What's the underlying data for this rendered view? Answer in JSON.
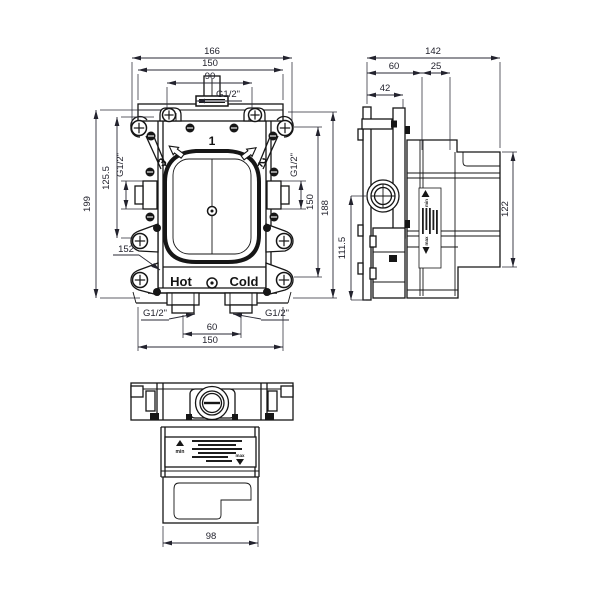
{
  "front": {
    "dim_overall_width": "166",
    "dim_flange_width_top": "150",
    "dim_top_port_span": "90",
    "thread_top": "G1/2\"",
    "dim_total_height": "199",
    "dim_side_port_height": "125.5",
    "thread_left": "G1/2\"",
    "dim_ref": "152",
    "thread_right": "G1/2\"",
    "dim_ear_span_right": "150",
    "dim_right_height": "188",
    "port_top": "1",
    "port_right": "2",
    "port_left": "3",
    "label_hot": "Hot",
    "label_cold": "Cold",
    "thread_bottom_left": "G1/2\"",
    "thread_bottom_right": "G1/2\"",
    "dim_bottom_port_span": "60",
    "dim_flange_width_bottom": "150"
  },
  "side": {
    "dim_total_depth": "142",
    "dim_front_depth": "60",
    "dim_mid_depth": "25",
    "dim_plate_depth": "42",
    "dim_lower_height": "111.5",
    "dim_body_height": "122",
    "sticker_min": "min",
    "sticker_max": "max"
  },
  "bottom": {
    "dim_body_width": "98",
    "sticker_min": "min",
    "sticker_max": "max"
  }
}
